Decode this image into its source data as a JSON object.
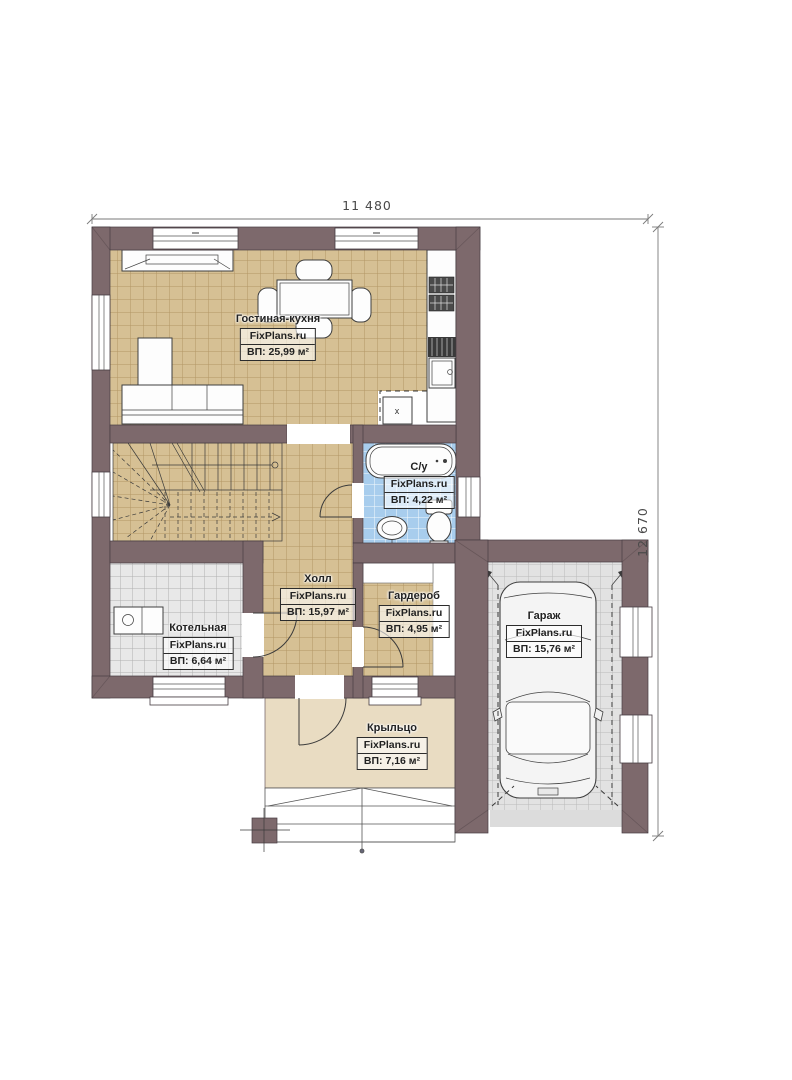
{
  "plan": {
    "type": "floor-plan",
    "watermark": "FixPlans.ru"
  },
  "dimensions": {
    "width": "11 480",
    "height": "12 670"
  },
  "rooms": [
    {
      "name": "Гостиная-кухня",
      "brand": "FixPlans.ru",
      "area": "ВП: 25,99 м²"
    },
    {
      "name": "С/у",
      "brand": "FixPlans.ru",
      "area": "ВП: 4,22 м²"
    },
    {
      "name": "Холл",
      "brand": "FixPlans.ru",
      "area": "ВП: 15,97 м²"
    },
    {
      "name": "Гардероб",
      "brand": "FixPlans.ru",
      "area": "ВП: 4,95 м²"
    },
    {
      "name": "Котельная",
      "brand": "FixPlans.ru",
      "area": "ВП: 6,64 м²"
    },
    {
      "name": "Гараж",
      "brand": "FixPlans.ru",
      "area": "ВП: 15,76 м²"
    },
    {
      "name": "Крыльцо",
      "brand": "FixPlans.ru",
      "area": "ВП: 7,16 м²"
    }
  ],
  "markers": {
    "appliance": "x"
  },
  "colors": {
    "wall": "#7d696c",
    "outline": "#463c42",
    "floor_tan": "#d6c094",
    "floor_gray": "#e8e8e8",
    "floor_blue": "#a8cded",
    "floor_garage": "#e2e2e2",
    "porch": "#e9dcc2",
    "dimension_text": "#4a4a4a"
  }
}
